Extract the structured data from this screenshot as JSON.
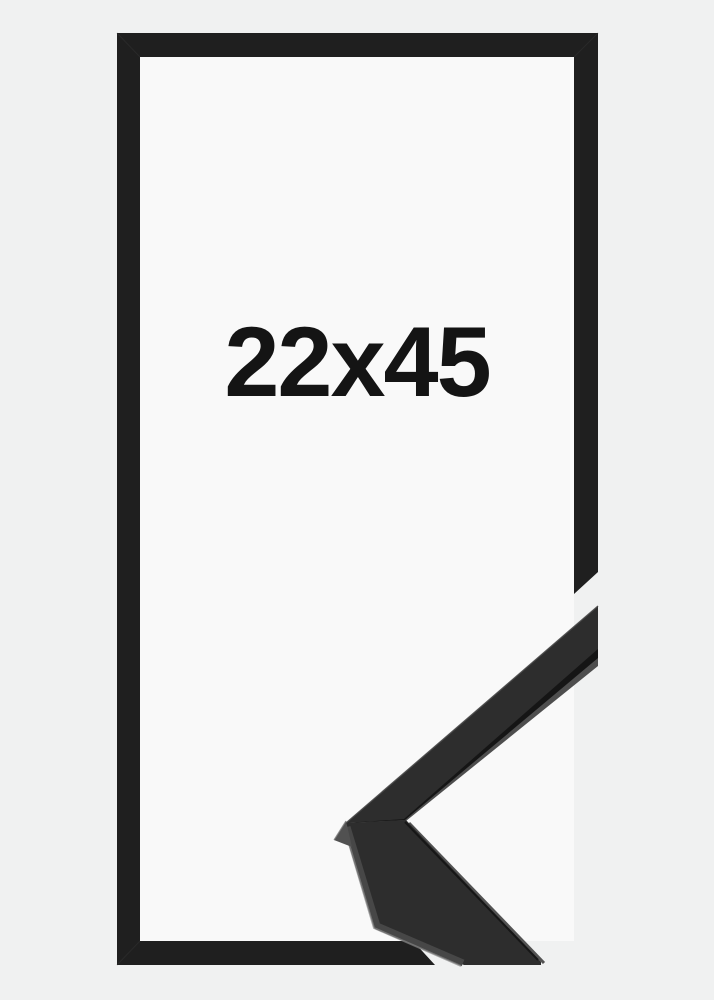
{
  "product": {
    "size_label": "22x45"
  },
  "colors": {
    "background": "#f0f1f1",
    "inner_backing": "#f9f9f9",
    "frame_black": "#1f1f1f",
    "label_text": "#141414",
    "molding_face": "#2d2d2d",
    "molding_edge_light": "#4e4e4e",
    "molding_groove": "#151515",
    "mitre_face": "#515151"
  }
}
